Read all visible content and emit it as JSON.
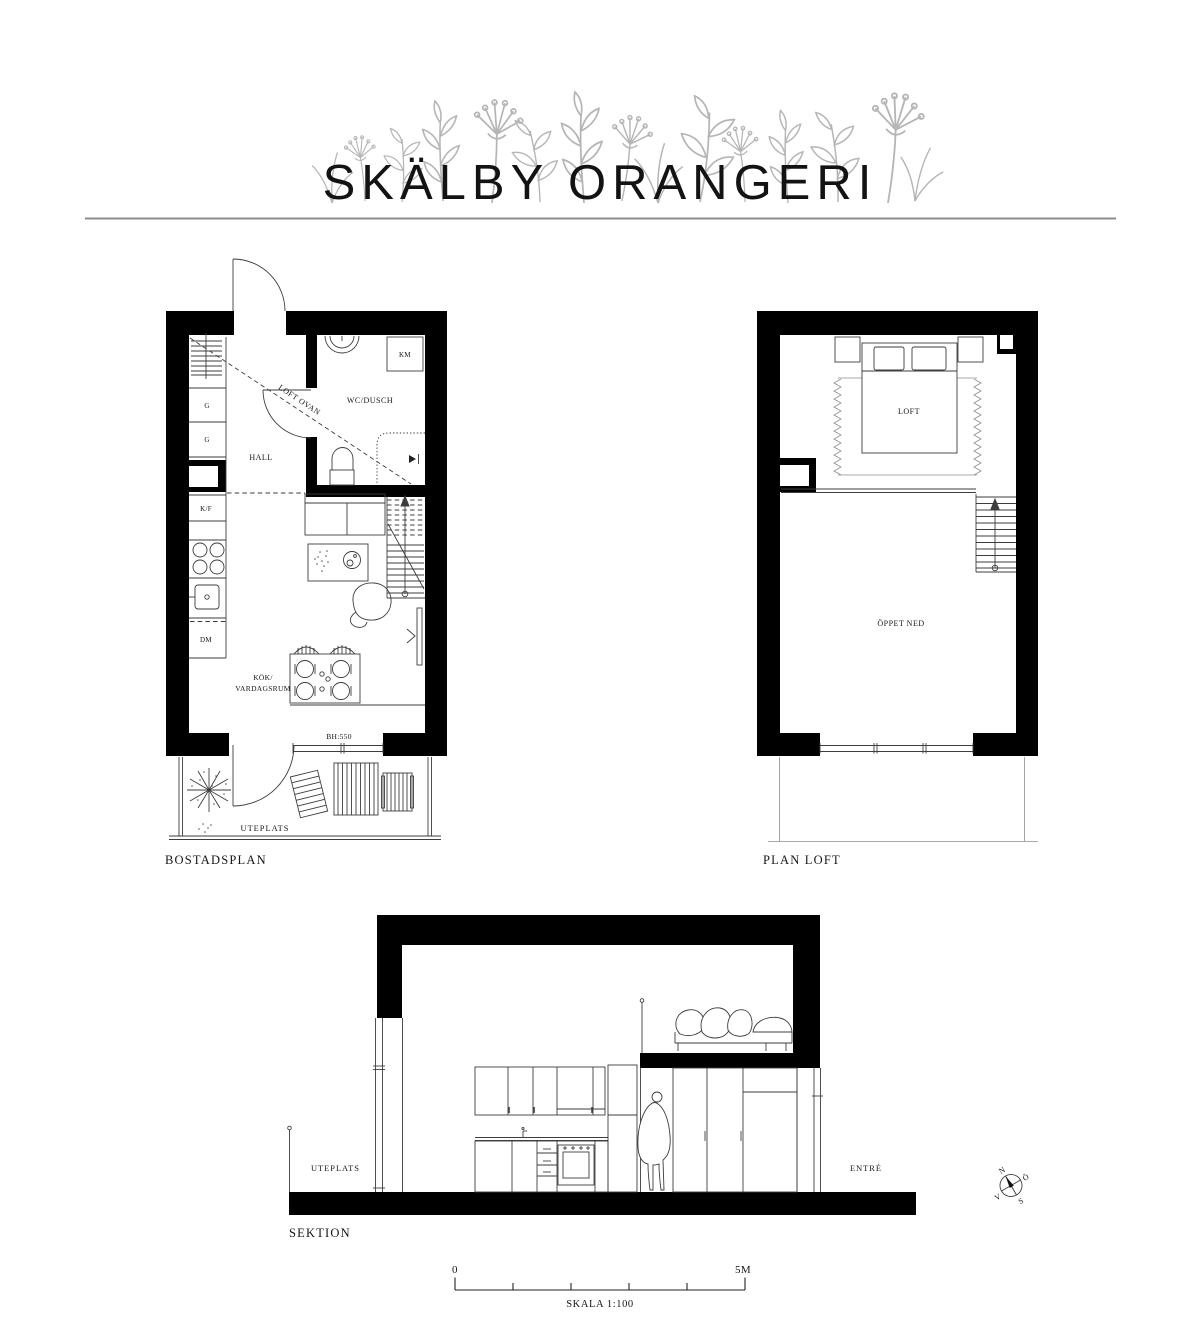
{
  "title": "SKÄLBY ORANGERI",
  "plans": {
    "bostadsplan": {
      "caption": "BOSTADSPLAN",
      "rooms": {
        "hall": "HALL",
        "wc_dusch": "WC/DUSCH",
        "kok": "KÖK/",
        "vardagsrum": "VARDAGSRUM",
        "uteplats": "UTEPLATS",
        "loft_ovan": "LOFT OVAN"
      },
      "fixtures": {
        "km": "KM",
        "g1": "G",
        "g2": "G",
        "kf": "K/F",
        "dm": "DM"
      },
      "annotations": {
        "bh": "BH:550"
      }
    },
    "plan_loft": {
      "caption": "PLAN LOFT",
      "rooms": {
        "loft": "LOFT",
        "oppet_ned": "ÖPPET NED"
      }
    },
    "sektion": {
      "caption": "SEKTION",
      "labels": {
        "uteplats": "UTEPLATS",
        "entre": "ENTRÉ"
      }
    }
  },
  "scale_bar": {
    "start": "0",
    "end": "5M",
    "caption": "SKALA 1:100"
  },
  "compass": {
    "north": "N",
    "east": "Ö",
    "south": "S",
    "west": "V"
  },
  "colors": {
    "ink": "#131313",
    "wall": "#000000",
    "line": "#3d3d3d",
    "light_line": "#8d8d8d",
    "plant": "#b5b5b5"
  }
}
